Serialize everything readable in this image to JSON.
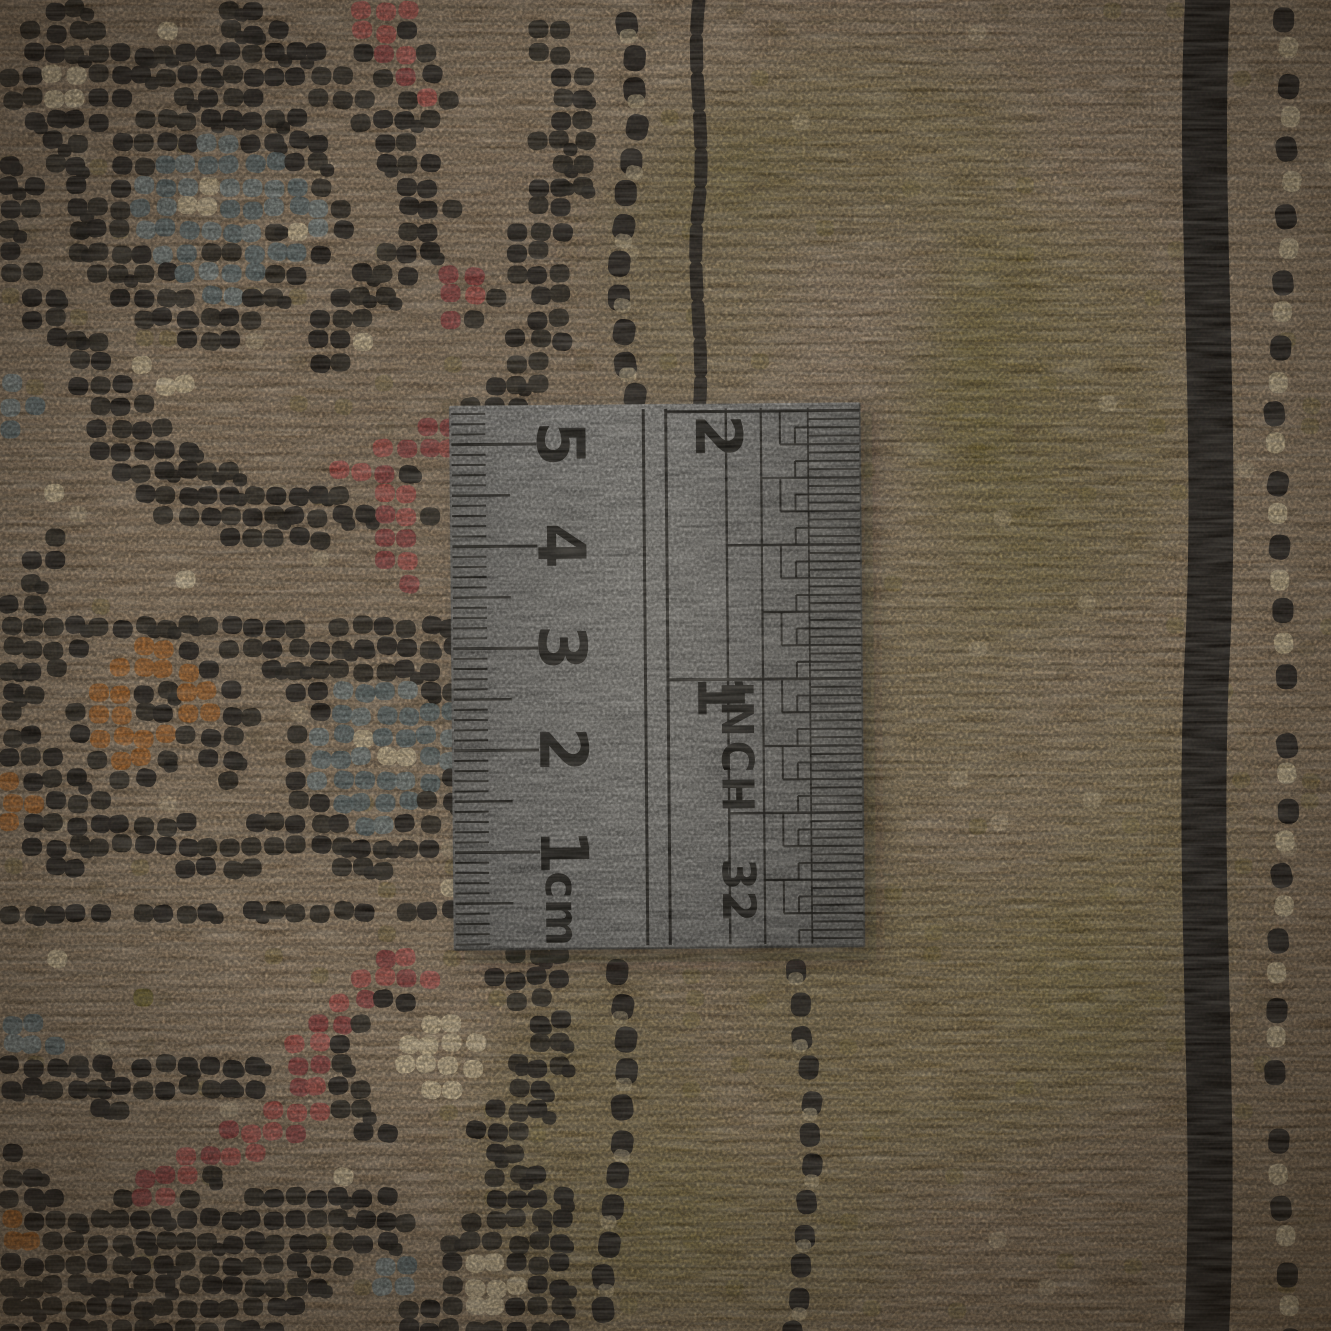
{
  "ruler": {
    "cm_scale": {
      "unit_label": "cm",
      "numbers": [
        "1",
        "2",
        "3",
        "4",
        "5"
      ]
    },
    "inch_scale": {
      "unit_label": "INCH",
      "denominator_label": "32",
      "numbers": [
        "1",
        "2"
      ]
    }
  },
  "palette": {
    "rug_tan": "#9c8264",
    "rug_tan_light": "#b29877",
    "rug_tan_dark": "#74603f",
    "rug_olive": "#7a6a30",
    "rug_olive_shadow": "#655827",
    "pile_black": "#1a1510",
    "pile_black_soft": "#272017",
    "pile_cream": "#d7c196",
    "pile_gray_blue": "#5f6b6a",
    "pile_gray_blue_light": "#7d8682",
    "pile_rust": "#ad6527",
    "pile_red": "#b5544a",
    "pile_red_deep": "#96403b",
    "ruler_metal_light": "#8f8d87",
    "ruler_metal_dark": "#67655f",
    "ruler_marking": "#15130f"
  }
}
